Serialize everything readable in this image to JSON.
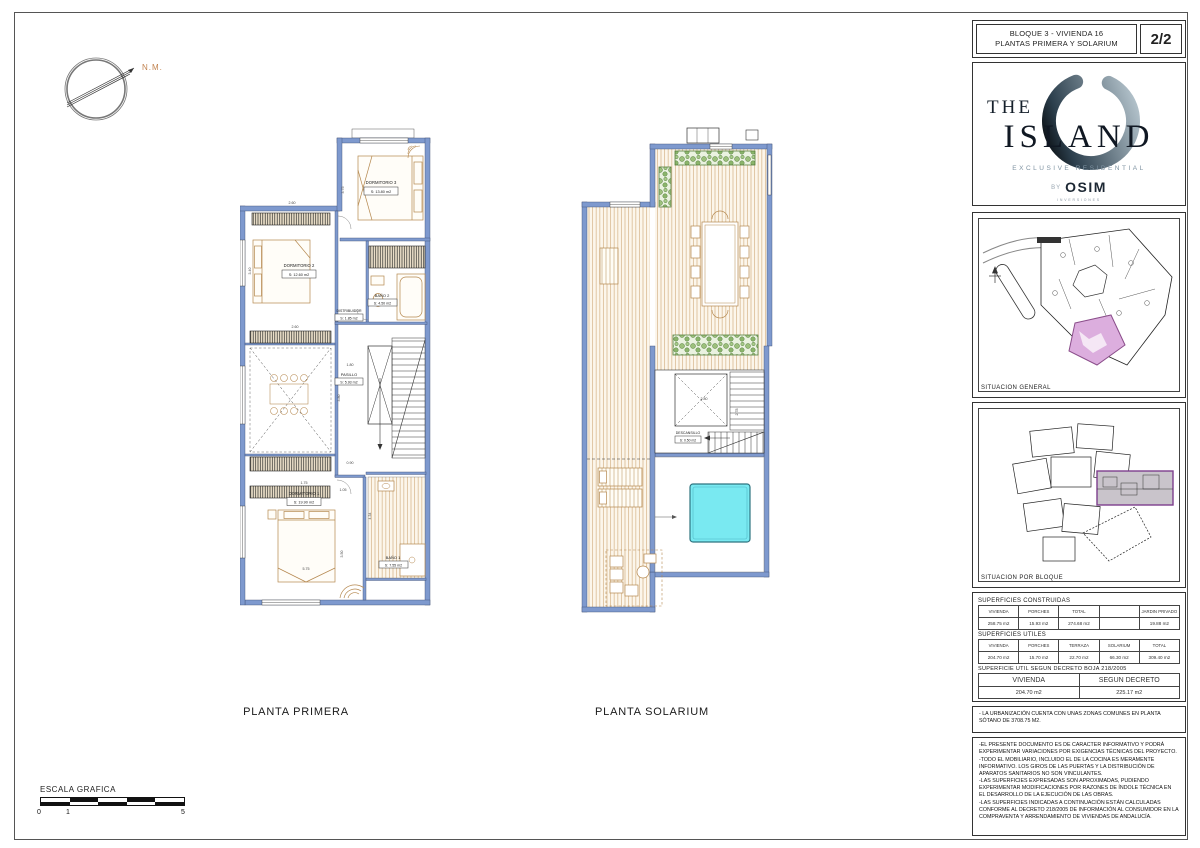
{
  "sheet": {
    "compass_label": "N.M.",
    "scale": {
      "title": "ESCALA GRAFICA",
      "ticks": [
        "0",
        "1",
        "5"
      ]
    }
  },
  "title_block": {
    "line1": "BLOQUE 3 - VIVIENDA 16",
    "line2": "PLANTAS PRIMERA Y SOLARIUM",
    "page": "2/2"
  },
  "logo": {
    "word_the": "THE",
    "word_island": "ISLAND",
    "tagline": "EXCLUSIVE RESIDENTIAL",
    "by": "BY",
    "brand": "OSIM",
    "brand_sub": "INVERSIONES"
  },
  "panels": {
    "situacion_general": "SITUACION GENERAL",
    "situacion_bloque": "SITUACION POR BLOQUE"
  },
  "surfaces": {
    "construidas": {
      "title": "SUPERFICIES CONSTRUIDAS",
      "headers": [
        "VIVIENDA",
        "PORCHES",
        "TOTAL",
        "",
        "JARDIN PRIVADO"
      ],
      "values": [
        "258.75 m2",
        "15.93 m2",
        "274.68 m2",
        "",
        "19.88 m2"
      ]
    },
    "utiles": {
      "title": "SUPERFICIES UTILES",
      "headers": [
        "VIVIENDA",
        "PORCHES",
        "TERRAZA",
        "SOLARIUM",
        "TOTAL"
      ],
      "values": [
        "204.70 m2",
        "15.70 m2",
        "22.70 m2",
        "66.30 m2",
        "309.40 m2"
      ]
    },
    "decreto": {
      "title": "SUPERFICIE UTIL SEGUN DECRETO BOJA 218/2005",
      "headers": [
        "VIVIENDA",
        "SEGUN DECRETO"
      ],
      "values": [
        "204.70 m2",
        "225.17 m2"
      ]
    }
  },
  "notes": {
    "zonas_comunes": "- LA URBANIZACIÓN CUENTA CON UNAS ZONAS COMUNES EN PLANTA SÓTANO DE 3708.75 M2.",
    "disclaimer": [
      "-EL PRESENTE DOCUMENTO ES DE CARACTER INFORMATIVO Y PODRÁ EXPERIMENTAR VARIACIONES POR EXIGENCIAS TÉCNICAS DEL PROYECTO.",
      "-TODO EL MOBILIARIO, INCLUIDO EL DE LA COCINA ES MERAMENTE INFORMATIVO. LOS GIROS DE LAS PUERTAS Y LA DISTRIBUCIÓN DE APARATOS SANITARIOS NO SON VINCULANTES.",
      "-LAS SUPERFICIES EXPRESADAS SON APROXIMADAS, PUDIENDO EXPERIMENTAR MODIFICACIONES POR RAZONES DE ÍNDOLE TÉCNICA EN EL DESARROLLO DE LA EJECUCIÓN DE LAS OBRAS.",
      "-LAS SUPERFICIES INDICADAS A CONTINUACIÓN ESTÁN CALCULADAS CONFORME AL DECRETO 218/2005 DE INFORMACIÓN AL CONSUMIDOR EN LA COMPRAVENTA Y ARRENDAMIENTO DE VIVIENDAS DE ANDALUCÍA."
    ]
  },
  "plans": {
    "primera": {
      "label": "PLANTA PRIMERA",
      "rooms": [
        {
          "name": "DORMITORIO 3",
          "area": "S: 13.80 m2"
        },
        {
          "name": "DORMITORIO 2",
          "area": "S: 12.60 m2"
        },
        {
          "name": "BAÑO 2",
          "area": "S: 4.50 m2"
        },
        {
          "name": "DISTRIBUIDOR",
          "area": "S: 1.85 m2"
        },
        {
          "name": "PASILLO",
          "area": "S: 5.93 m2"
        },
        {
          "name": "DORMITORIO 1",
          "area": "S: 19.90 m2"
        },
        {
          "name": "BAÑO 1",
          "area": "S: 7.55 m2"
        }
      ],
      "dims": [
        "2.60",
        "3.40",
        "3.75",
        "2.60",
        "1.80",
        "3.80",
        "0.90",
        "1.05",
        "4.34",
        "3.50",
        "1.75",
        "5.75"
      ]
    },
    "solarium": {
      "label": "PLANTA SOLARIUM",
      "rooms": [
        {
          "name": "DESCANSILLO",
          "area": "S: 0.50 m2"
        }
      ],
      "dims": [
        "2.80",
        "2.78"
      ]
    }
  },
  "colors": {
    "wall_blue": "#7e99ce",
    "furniture_tan": "#b5884f",
    "deck_line_tan": "#d4b286",
    "planter_green": "#567f3e",
    "pool_cyan": "#79e9f1",
    "highlight_pink": "#dcaede",
    "highlight_purple": "#7d3f8d",
    "compass_orange": "#c1824e"
  }
}
